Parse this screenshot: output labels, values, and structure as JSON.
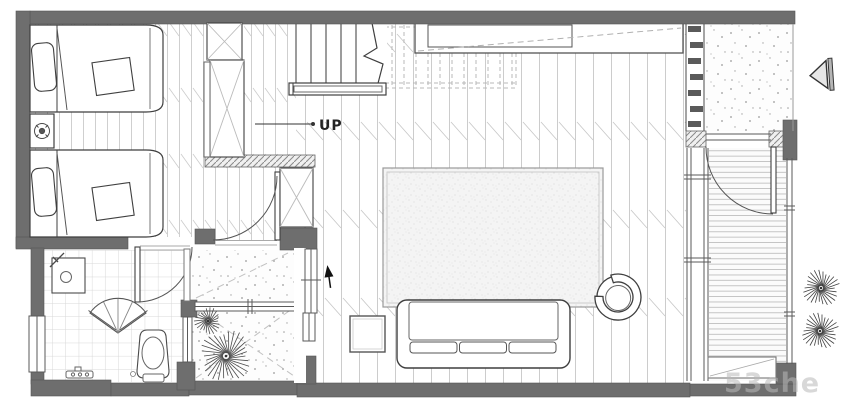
{
  "labels": {
    "stair_direction": "UP",
    "watermark": "53che"
  },
  "colors": {
    "wall": "#6e6e6e",
    "outline": "#3f3f3f",
    "floor_line": "#cccccc",
    "window": "#5a5a5a",
    "watermark": "#b9b9b9",
    "background": "#ffffff"
  },
  "markers": {
    "entry_arrow": "left-pointing-triangle",
    "interior_arrow": "up-arrow"
  },
  "plants": [
    {
      "name": "courtyard-large",
      "x": 226,
      "y": 356,
      "r": 27,
      "spokes": 30,
      "color": "#4a4a4a"
    },
    {
      "name": "courtyard-small",
      "x": 208,
      "y": 321,
      "r": 14,
      "spokes": 22,
      "color": "#4a4a4a"
    },
    {
      "name": "outside-upper",
      "x": 821,
      "y": 288,
      "r": 19,
      "spokes": 26,
      "color": "#3f3f3f"
    },
    {
      "name": "outside-lower",
      "x": 820,
      "y": 331,
      "r": 19,
      "spokes": 26,
      "color": "#3f3f3f"
    }
  ]
}
